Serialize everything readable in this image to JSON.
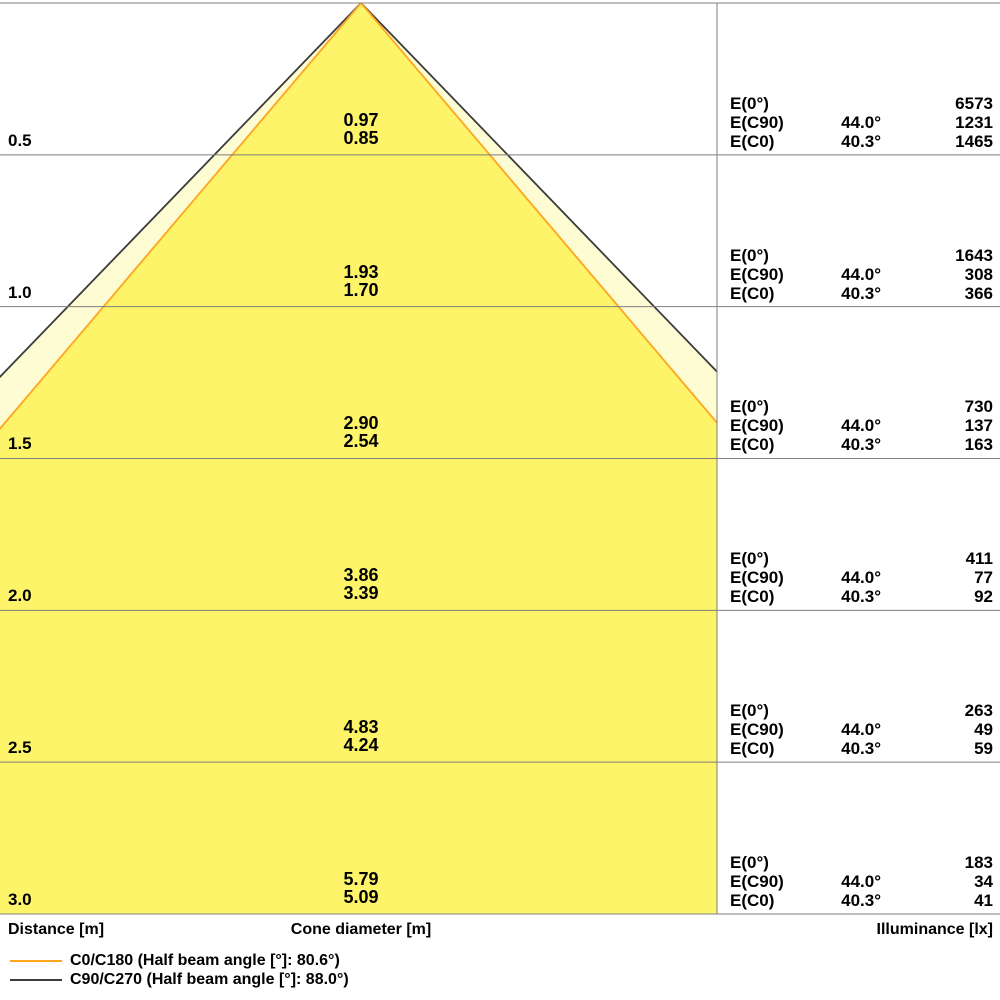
{
  "chart_data": {
    "type": "area",
    "subtype": "luminous-cone-diagram",
    "axis_labels": {
      "distance": "Distance [m]",
      "cone_diameter": "Cone diameter [m]",
      "illuminance": "Illuminance [lx]"
    },
    "distances_m": [
      0.5,
      1.0,
      1.5,
      2.0,
      2.5,
      3.0
    ],
    "max_distance_m": 3.0,
    "grid_color": "#7F7F7F",
    "series": [
      {
        "name": "C0/C180",
        "legend_label": "C0/C180 (Half beam angle [°]: 80.6°)",
        "half_beam_angle_deg": 80.6,
        "half_angle_deg": 40.3,
        "color": "#FFA520",
        "fill": "#FDF46A",
        "cone_diameters_m": [
          0.85,
          1.7,
          2.54,
          3.39,
          4.24,
          5.09
        ]
      },
      {
        "name": "C90/C270",
        "legend_label": "C90/C270 (Half beam angle [°]: 88.0°)",
        "half_beam_angle_deg": 88.0,
        "half_angle_deg": 44.0,
        "color": "#3C3C3C",
        "fill": "#FEFCD2",
        "cone_diameters_m": [
          0.97,
          1.93,
          2.9,
          3.86,
          4.83,
          5.79
        ]
      }
    ],
    "illuminance": {
      "E0_lx": [
        6573,
        1643,
        730,
        411,
        263,
        183
      ],
      "EC90_angle_deg": 44.0,
      "EC90_lx": [
        1231,
        308,
        137,
        77,
        49,
        34
      ],
      "EC0_angle_deg": 40.3,
      "EC0_lx": [
        1465,
        366,
        163,
        92,
        59,
        41
      ]
    },
    "bands": [
      {
        "distance": "0.5",
        "dia_c90": "0.97",
        "dia_c0": "0.85",
        "rows": [
          {
            "label": "E(0°)",
            "angle": "",
            "value": "6573"
          },
          {
            "label": "E(C90)",
            "angle": "44.0°",
            "value": "1231"
          },
          {
            "label": "E(C0)",
            "angle": "40.3°",
            "value": "1465"
          }
        ]
      },
      {
        "distance": "1.0",
        "dia_c90": "1.93",
        "dia_c0": "1.70",
        "rows": [
          {
            "label": "E(0°)",
            "angle": "",
            "value": "1643"
          },
          {
            "label": "E(C90)",
            "angle": "44.0°",
            "value": "308"
          },
          {
            "label": "E(C0)",
            "angle": "40.3°",
            "value": "366"
          }
        ]
      },
      {
        "distance": "1.5",
        "dia_c90": "2.90",
        "dia_c0": "2.54",
        "rows": [
          {
            "label": "E(0°)",
            "angle": "",
            "value": "730"
          },
          {
            "label": "E(C90)",
            "angle": "44.0°",
            "value": "137"
          },
          {
            "label": "E(C0)",
            "angle": "40.3°",
            "value": "163"
          }
        ]
      },
      {
        "distance": "2.0",
        "dia_c90": "3.86",
        "dia_c0": "3.39",
        "rows": [
          {
            "label": "E(0°)",
            "angle": "",
            "value": "411"
          },
          {
            "label": "E(C90)",
            "angle": "44.0°",
            "value": "77"
          },
          {
            "label": "E(C0)",
            "angle": "40.3°",
            "value": "92"
          }
        ]
      },
      {
        "distance": "2.5",
        "dia_c90": "4.83",
        "dia_c0": "4.24",
        "rows": [
          {
            "label": "E(0°)",
            "angle": "",
            "value": "263"
          },
          {
            "label": "E(C90)",
            "angle": "44.0°",
            "value": "49"
          },
          {
            "label": "E(C0)",
            "angle": "40.3°",
            "value": "59"
          }
        ]
      },
      {
        "distance": "3.0",
        "dia_c90": "5.79",
        "dia_c0": "5.09",
        "rows": [
          {
            "label": "E(0°)",
            "angle": "",
            "value": "183"
          },
          {
            "label": "E(C90)",
            "angle": "44.0°",
            "value": "34"
          },
          {
            "label": "E(C0)",
            "angle": "40.3°",
            "value": "41"
          }
        ]
      }
    ]
  }
}
